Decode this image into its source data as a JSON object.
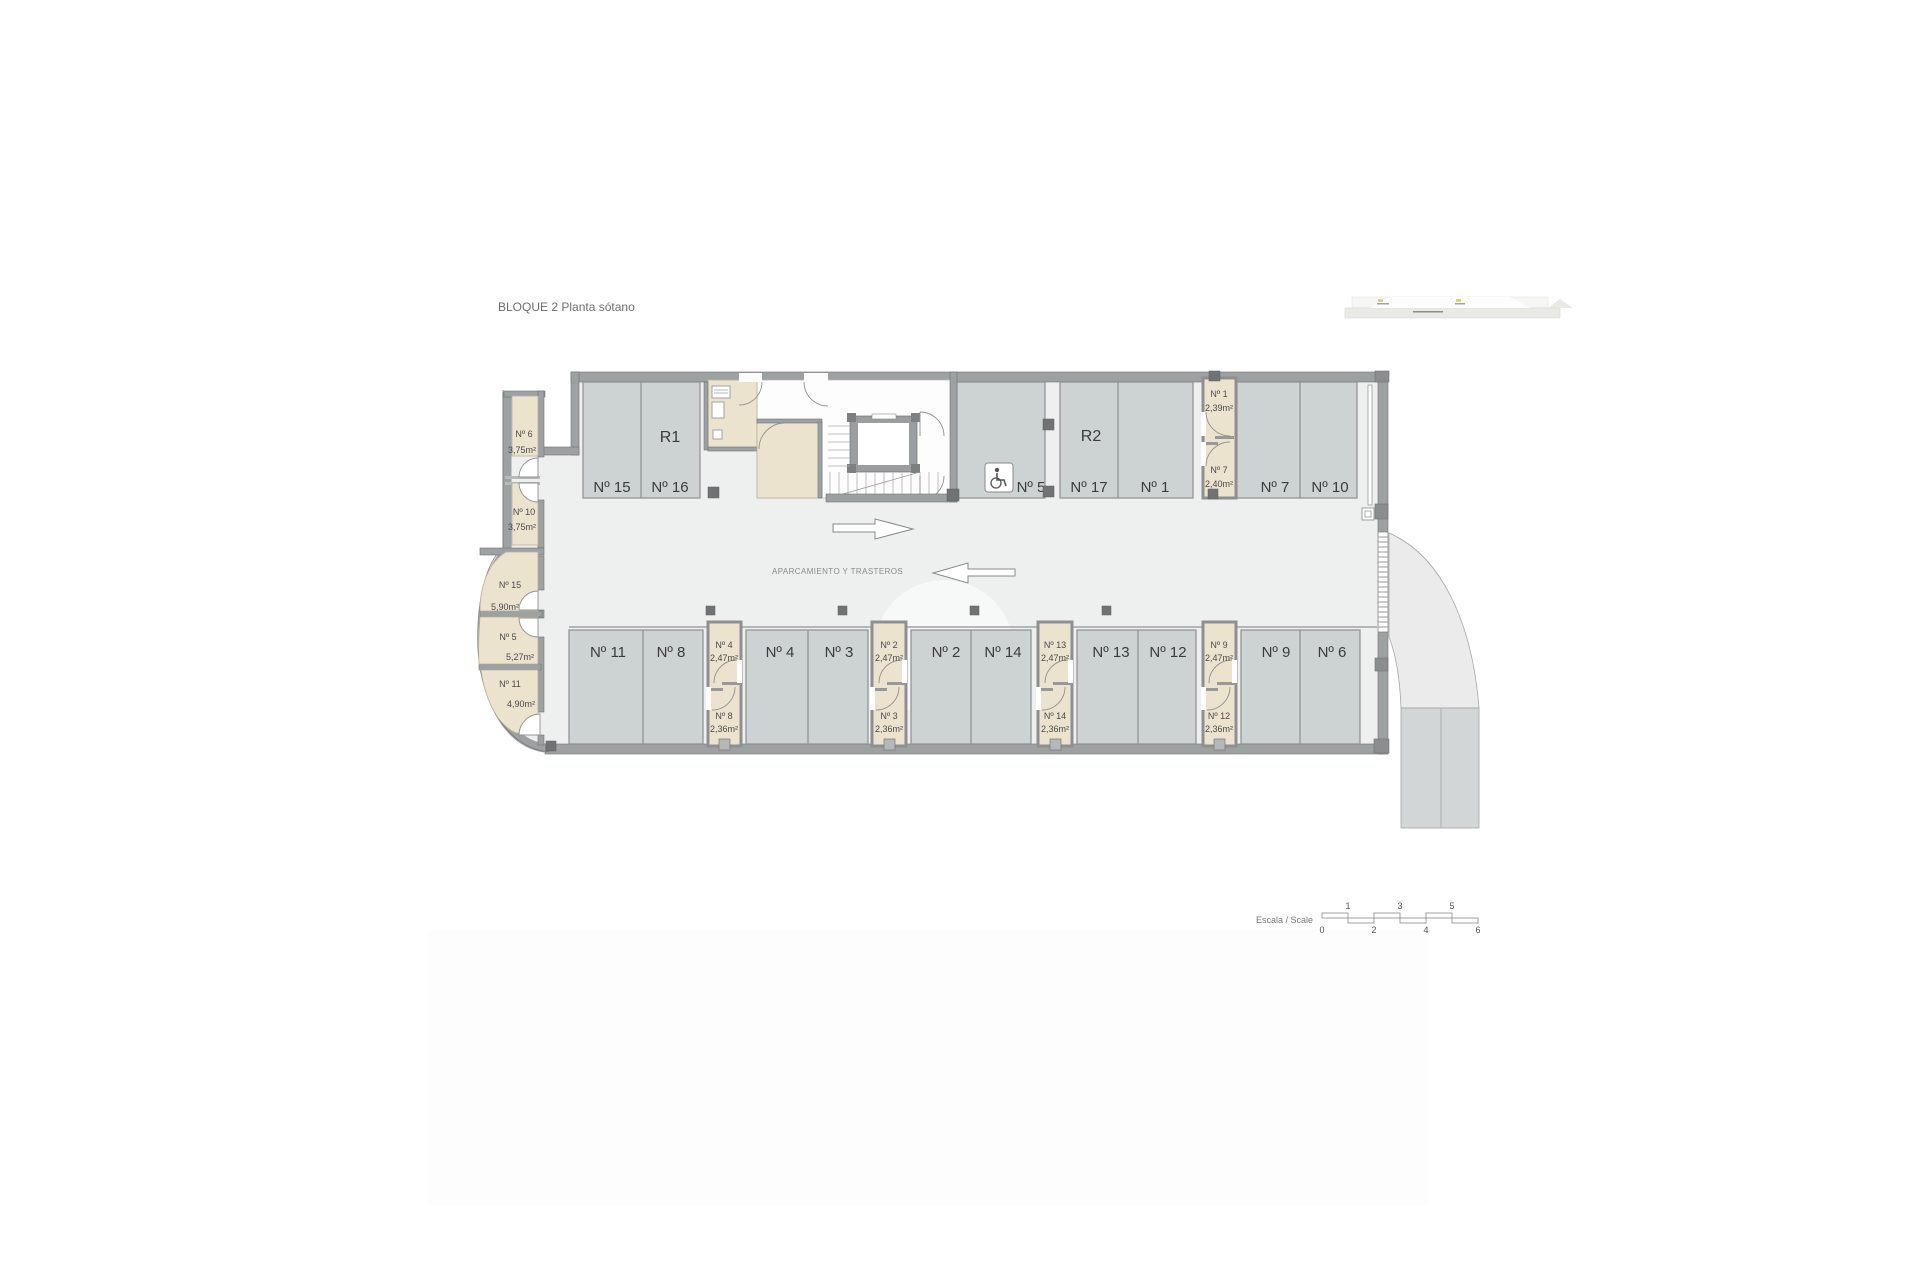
{
  "title": "BLOQUE 2 Planta sótano",
  "plan": {
    "area_label": "APARCAMIENTO Y TRASTEROS",
    "zones": [
      {
        "label": "R1"
      },
      {
        "label": "R2"
      }
    ],
    "parking_top": [
      {
        "label": "Nº 15"
      },
      {
        "label": "Nº 16"
      },
      {
        "label": "Nº 5"
      },
      {
        "label": "Nº 17"
      },
      {
        "label": "Nº 1"
      },
      {
        "label": "Nº 7"
      },
      {
        "label": "Nº 10"
      }
    ],
    "parking_bottom": [
      {
        "label": "Nº 11"
      },
      {
        "label": "Nº 8"
      },
      {
        "label": "Nº 4"
      },
      {
        "label": "Nº 3"
      },
      {
        "label": "Nº 2"
      },
      {
        "label": "Nº 14"
      },
      {
        "label": "Nº 13"
      },
      {
        "label": "Nº 12"
      },
      {
        "label": "Nº 9"
      },
      {
        "label": "Nº 6"
      }
    ],
    "storage_left": [
      {
        "label": "Nº 6",
        "area": "3,75m²"
      },
      {
        "label": "Nº 10",
        "area": "3,75m²"
      },
      {
        "label": "Nº 15",
        "area": "5,90m²"
      },
      {
        "label": "Nº 5",
        "area": "5,27m²"
      },
      {
        "label": "Nº 11",
        "area": "4,90m²"
      }
    ],
    "storage_top": [
      {
        "label": "Nº 1",
        "area": "2,39m²"
      },
      {
        "label": "Nº 7",
        "area": "2,40m²"
      }
    ],
    "storage_bottom": [
      {
        "label": "Nº 4",
        "area": "2,47m²"
      },
      {
        "label": "Nº 8",
        "area": "2,36m²"
      },
      {
        "label": "Nº 2",
        "area": "2,47m²"
      },
      {
        "label": "Nº 3",
        "area": "2,36m²"
      },
      {
        "label": "Nº 13",
        "area": "2,47m²"
      },
      {
        "label": "Nº 14",
        "area": "2,36m²"
      },
      {
        "label": "Nº 9",
        "area": "2,47m²"
      },
      {
        "label": "Nº 12",
        "area": "2,36m²"
      }
    ],
    "icons": {
      "wheelchair_icon": "accessible-parking",
      "arrow_right_icon": "drive-direction-right",
      "arrow_left_icon": "drive-direction-left"
    }
  },
  "scale_bar": {
    "label": "Escala / Scale",
    "ticks": [
      "0",
      "1",
      "2",
      "3",
      "4",
      "5",
      "6"
    ]
  },
  "colors": {
    "floor": "#EEF0F0",
    "stall": "#CDD2D3",
    "stall_border": "#8B9091",
    "wall": "#9DA1A2",
    "wall_dark": "#6F7374",
    "storage": "#ECE3CF",
    "ramp": "#EBEBEB",
    "road": "#D3D6D6",
    "text_dark": "#3B3B3B",
    "text_gray": "#8A8A8A"
  }
}
